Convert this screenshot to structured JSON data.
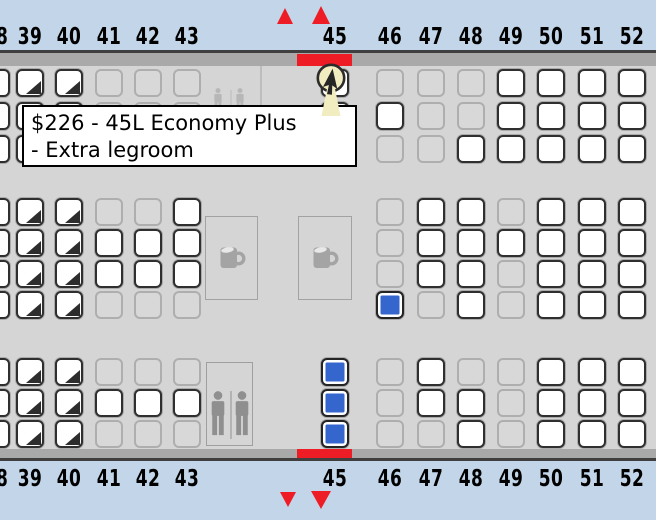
{
  "colors": {
    "header_background": "#c3d6e9",
    "map_background": "#d5d5d5",
    "rail_gray": "#a9a9a9",
    "rail_dark_line": "#3f3f3f",
    "accent_red": "#ee1c25",
    "seat_available_fill": "#ffffff",
    "seat_available_border": "#2f2f2f",
    "seat_blocked_fill": "#d8d8d8",
    "seat_blocked_border": "#aeaeae",
    "seat_selected_fill": "#3566ce",
    "fixture_gray": "#a4a4a4",
    "lavatory_icon_gray": "#8f8f8f",
    "cursor_cream": "#f2edc0"
  },
  "tooltip": {
    "line1": "$226 - 45L Economy Plus",
    "line2": "- Extra legroom"
  },
  "seat_map": {
    "seat_size": 28,
    "codes": {
      "W": "available",
      "G": "unavailable",
      "D": "economy-plus-available",
      "B": "selected",
      "-": "no-seat"
    },
    "columns": [
      {
        "id": "38",
        "x": -18
      },
      {
        "id": "39",
        "x": 16
      },
      {
        "id": "40",
        "x": 55
      },
      {
        "id": "41",
        "x": 95
      },
      {
        "id": "42",
        "x": 134
      },
      {
        "id": "43",
        "x": 173
      },
      {
        "id": "45",
        "x": 321
      },
      {
        "id": "46",
        "x": 376
      },
      {
        "id": "47",
        "x": 417
      },
      {
        "id": "48",
        "x": 457
      },
      {
        "id": "49",
        "x": 497
      },
      {
        "id": "50",
        "x": 537
      },
      {
        "id": "51",
        "x": 578
      },
      {
        "id": "52",
        "x": 618
      }
    ],
    "sections": [
      {
        "id": "top",
        "rows_y": [
          69,
          102,
          135
        ],
        "states": [
          "WDDGGGWGGGWWWW",
          "WDDGGGWWGGWWWW",
          "WDDGGGWGGWWWWW"
        ]
      },
      {
        "id": "middle",
        "rows_y": [
          198,
          229,
          260,
          291
        ],
        "states": [
          "WDDGGW-GWWGWWW",
          "WDDWWW-GWWWWWW",
          "WDDWWW-GWWGWWW",
          "WDDGGG-BGWGWWW"
        ]
      },
      {
        "id": "bottom",
        "rows_y": [
          358,
          389,
          420
        ],
        "states": [
          "WDDGGGBGWGGWWW",
          "WDDWWWBGWWGWWW",
          "WDDGGGBGGWGWWW"
        ]
      }
    ],
    "fixtures": {
      "galleys": [
        {
          "x": 205,
          "y": 216,
          "w": 53,
          "h": 84
        },
        {
          "x": 298,
          "y": 216,
          "w": 54,
          "h": 84
        }
      ],
      "lavatory_bottom": {
        "x": 206,
        "y": 362,
        "w": 47,
        "h": 84
      },
      "lavatory_top_icons": {
        "x": 212,
        "y": 88,
        "w": 40,
        "h": 24
      },
      "wall_top": {
        "x": 260,
        "y": 66,
        "h": 41
      }
    },
    "exit_row_highlight": {
      "x": 297,
      "w": 55
    },
    "exit_markers": {
      "top": [
        {
          "x": 277,
          "y": 8,
          "w": 17,
          "h": 16
        },
        {
          "x": 312,
          "y": 6,
          "w": 19,
          "h": 18
        }
      ],
      "bottom": [
        {
          "x": 280,
          "y": 492,
          "w": 16,
          "h": 15
        },
        {
          "x": 311,
          "y": 491,
          "w": 20,
          "h": 18
        }
      ]
    },
    "cursor": {
      "x": 312,
      "y": 60
    }
  }
}
